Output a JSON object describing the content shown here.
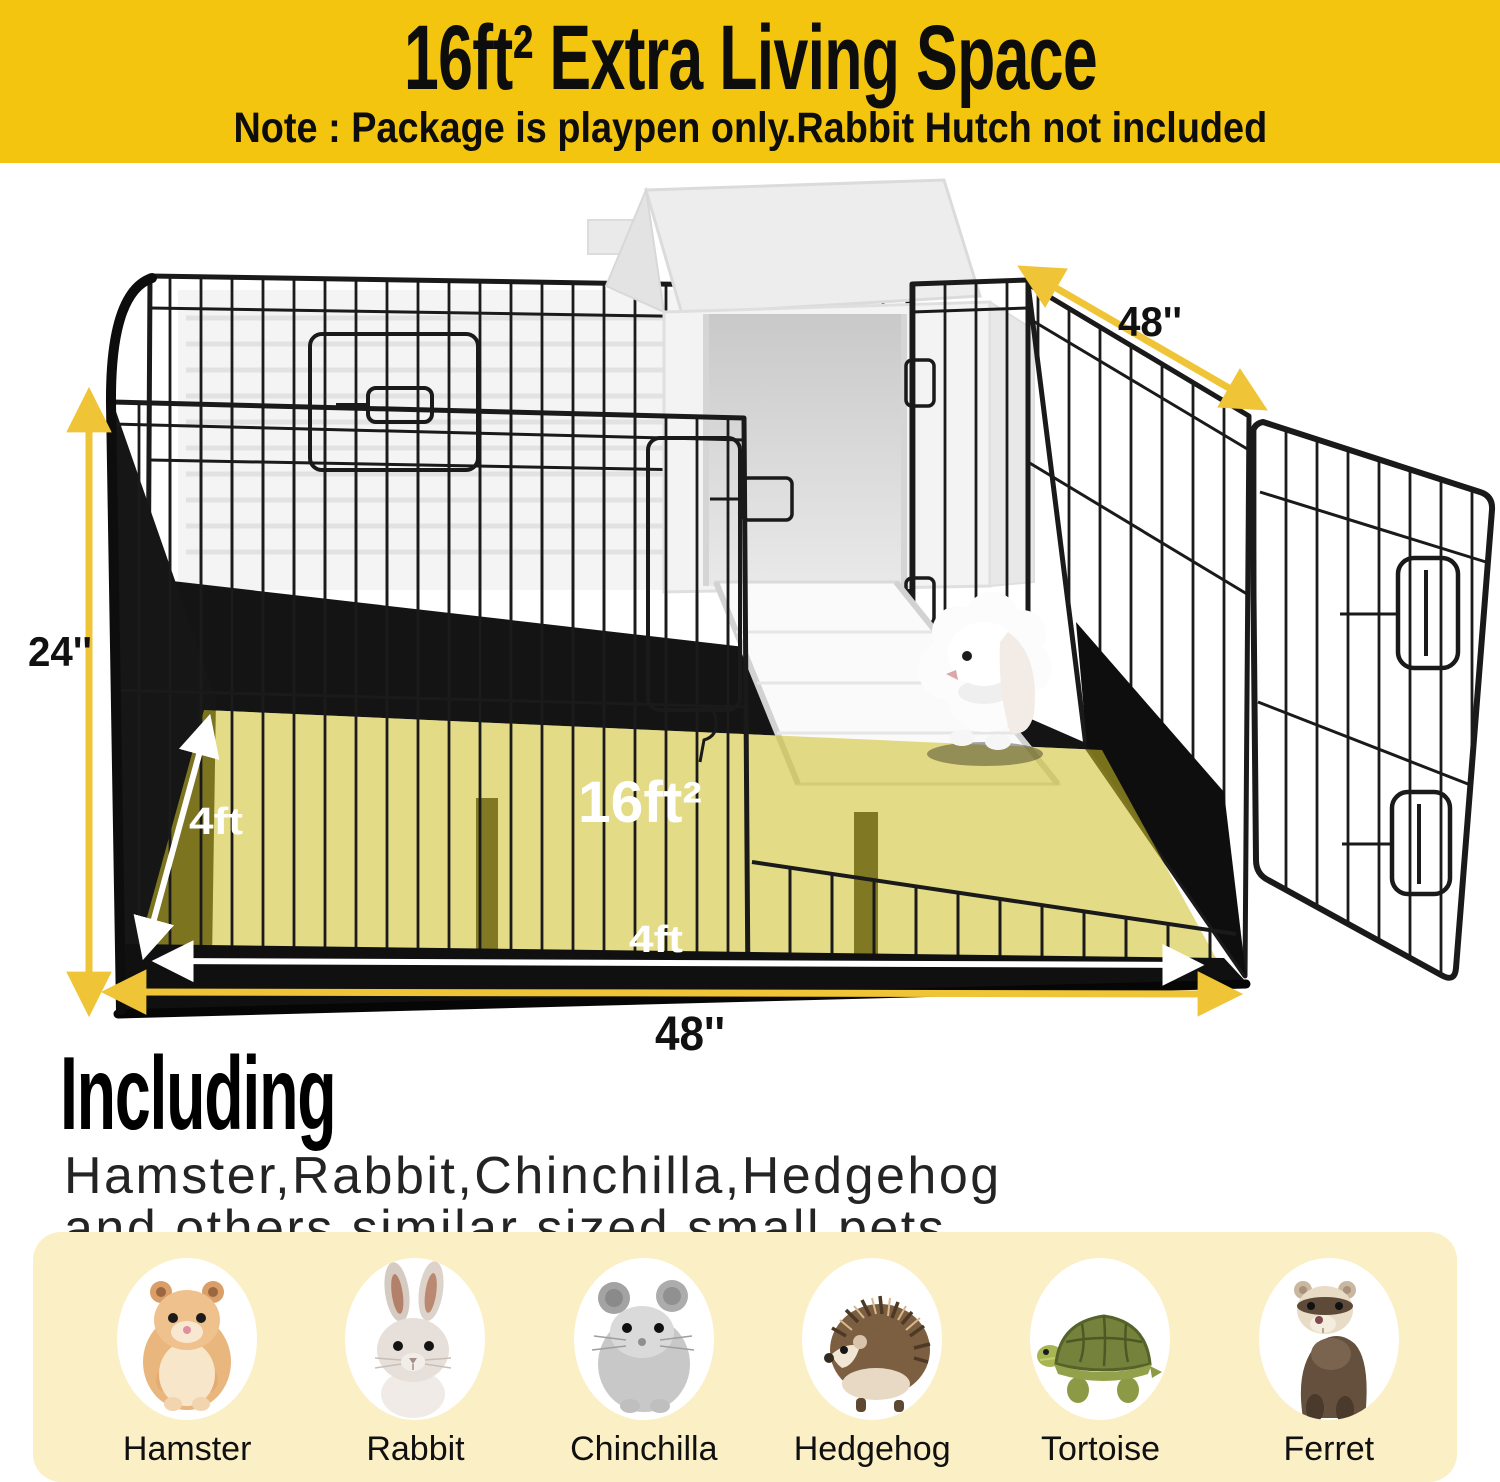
{
  "banner": {
    "title": "16ft² Extra Living Space",
    "note": "Note : Package is playpen only.Rabbit Hutch not included"
  },
  "diagram": {
    "area_label": "16ft²",
    "top_width_label": "48''",
    "height_label": "24''",
    "depth_label": "4ft",
    "front_width_label": "4ft",
    "bottom_width_label": "48''",
    "icons": {
      "yellow_dimension_arrow": "double-headed-arrow",
      "white_dimension_arrow": "double-headed-arrow"
    }
  },
  "including": {
    "heading": "Including",
    "line1": "Hamster,Rabbit,Chinchilla,Hedgehog",
    "line2": "and others similar sized small pets"
  },
  "animals": {
    "items": [
      {
        "label": "Hamster",
        "icon": "hamster-icon"
      },
      {
        "label": "Rabbit",
        "icon": "rabbit-icon"
      },
      {
        "label": "Chinchilla",
        "icon": "chinchilla-icon"
      },
      {
        "label": "Hedgehog",
        "icon": "hedgehog-icon"
      },
      {
        "label": "Tortoise",
        "icon": "tortoise-icon"
      },
      {
        "label": "Ferret",
        "icon": "ferret-icon"
      }
    ]
  },
  "colors": {
    "banner_yellow": "#F3C50E",
    "arrow_yellow": "#EFC437",
    "floor_highlight_olive": "#CEBE28",
    "panel_cream": "#FBEFC6",
    "wire_black": "#1B1B1B"
  }
}
